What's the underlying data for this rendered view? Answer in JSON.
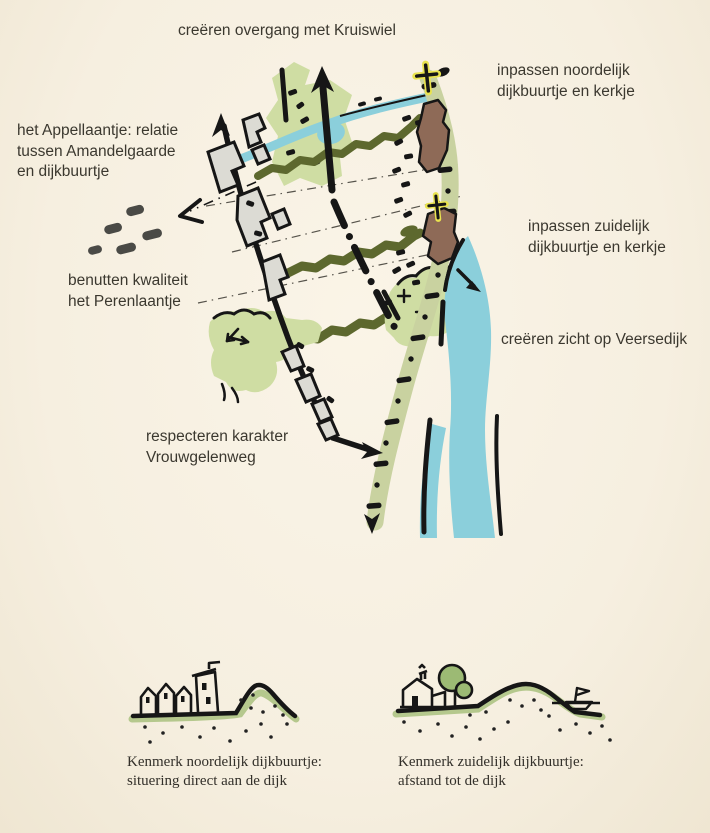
{
  "title": "landscape concept sketch map",
  "map_labels": {
    "kruiswiel": [
      "creëren overgang met Kruiswiel"
    ],
    "noordelijk": [
      "inpassen noordelijk",
      "dijkbuurtje en kerkje"
    ],
    "appellaantje": [
      "het Appellaantje: relatie",
      "tussen Amandelgaarde",
      "en dijkbuurtje"
    ],
    "zuidelijk": [
      "inpassen zuidelijk",
      "dijkbuurtje en kerkje"
    ],
    "perenlaantje": [
      "benutten kwaliteit",
      "het Perenlaantje"
    ],
    "veersedijk": [
      "creëren zicht op Veersedijk"
    ],
    "vrouwgelenweg": [
      "respecteren karakter",
      "Vrouwgelenweg"
    ]
  },
  "captions": {
    "noordelijk": [
      "Kenmerk noordelijk dijkbuurtje:",
      "situering direct aan de dijk"
    ],
    "zuidelijk": [
      "Kenmerk zuidelijk dijkbuurtje:",
      "afstand tot de dijk"
    ]
  },
  "icons": {
    "church_north": "church-cross",
    "church_south": "church-cross",
    "direction_arrows": "bold sketch arrows",
    "dike_symbol": "dash-dot ladder line",
    "tree_rows": "wavy olive lines"
  },
  "colors": {
    "background": "#f7f0e1",
    "ink": "#161616",
    "text": "#3b382f",
    "water": "#8bcfdb",
    "orchard_green": "#cfdda3",
    "dike_band_green": "#c9d2a0",
    "tree_row_olive": "#5d682e",
    "village_brown": "#8e6a57",
    "church_yellow": "#e9e34f",
    "building_gray": "#dcdbd4",
    "sketch_ground_green": "#b5c88d",
    "sketch_tree_green": "#9cba74"
  }
}
